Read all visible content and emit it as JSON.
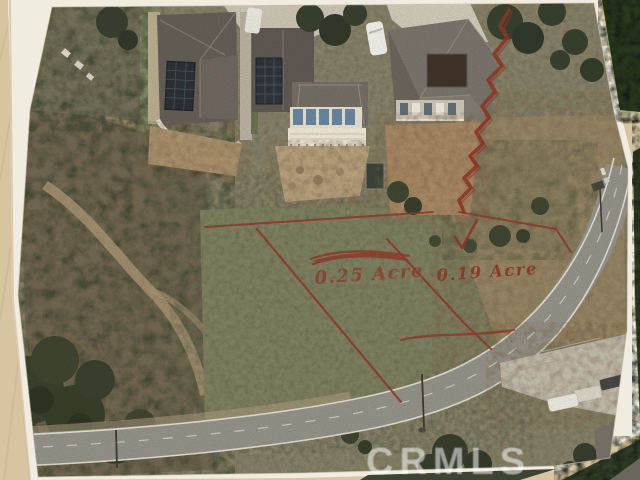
{
  "annotations": {
    "ink_color": "#8b2e1d",
    "lot_labels": [
      {
        "text": "0.25 Acre",
        "struck_through": true
      },
      {
        "text": "0.19 Acre",
        "struck_through": false
      }
    ]
  },
  "watermark": {
    "text": "CRMLS",
    "color": "rgba(255,255,255,0.52)"
  }
}
